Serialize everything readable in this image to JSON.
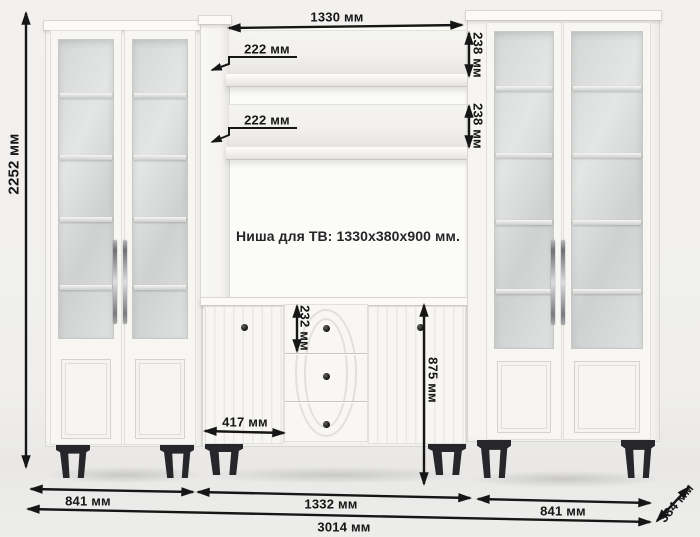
{
  "diagram": {
    "note_tv_niche": "Ниша для ТВ: 1330x380x900 мм.",
    "dims": {
      "total_height": "2252 мм",
      "niche_width_top": "1330 мм",
      "shelf_depth_top": "222 мм",
      "shelf_depth_bottom": "222 мм",
      "shelf_clearance_top": "238 мм",
      "shelf_clearance_bottom": "238 мм",
      "drawer_height": "232 мм",
      "stand_door_width": "417 мм",
      "stand_height": "875 мм",
      "left_cabinet_width": "841 мм",
      "center_section_width": "1332 мм",
      "right_cabinet_width": "841 мм",
      "total_width": "3014 мм",
      "depth": "384 мм"
    },
    "colors": {
      "dimension_ink": "#161616",
      "furniture_white": "#f6f5f2",
      "legs_black": "#27272b",
      "background": "#f0efed"
    }
  }
}
